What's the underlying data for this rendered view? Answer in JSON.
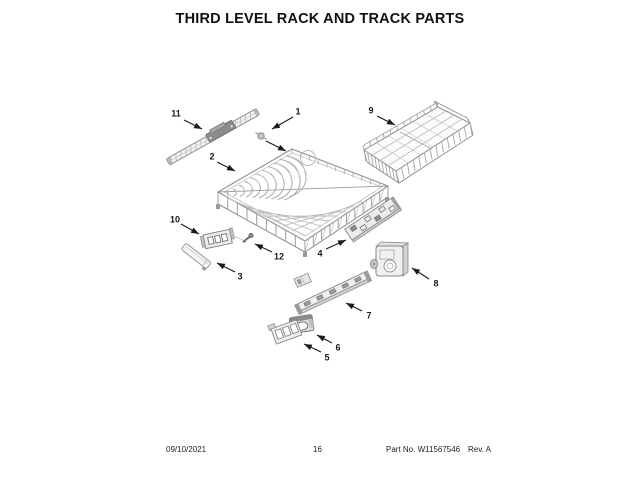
{
  "title": "THIRD LEVEL RACK AND TRACK PARTS",
  "callouts": [
    {
      "num": "1"
    },
    {
      "num": "2"
    },
    {
      "num": "3"
    },
    {
      "num": "4"
    },
    {
      "num": "5"
    },
    {
      "num": "6"
    },
    {
      "num": "7"
    },
    {
      "num": "8"
    },
    {
      "num": "9"
    },
    {
      "num": "10"
    },
    {
      "num": "11"
    },
    {
      "num": "12"
    }
  ],
  "footer": {
    "date": "09/10/2021",
    "page": "16",
    "part_no": "Part No. W11567546",
    "rev": "Rev. A"
  },
  "colors": {
    "line_art": "#8f8f8f",
    "callout_text": "#1a1a1a",
    "background": "#ffffff"
  }
}
